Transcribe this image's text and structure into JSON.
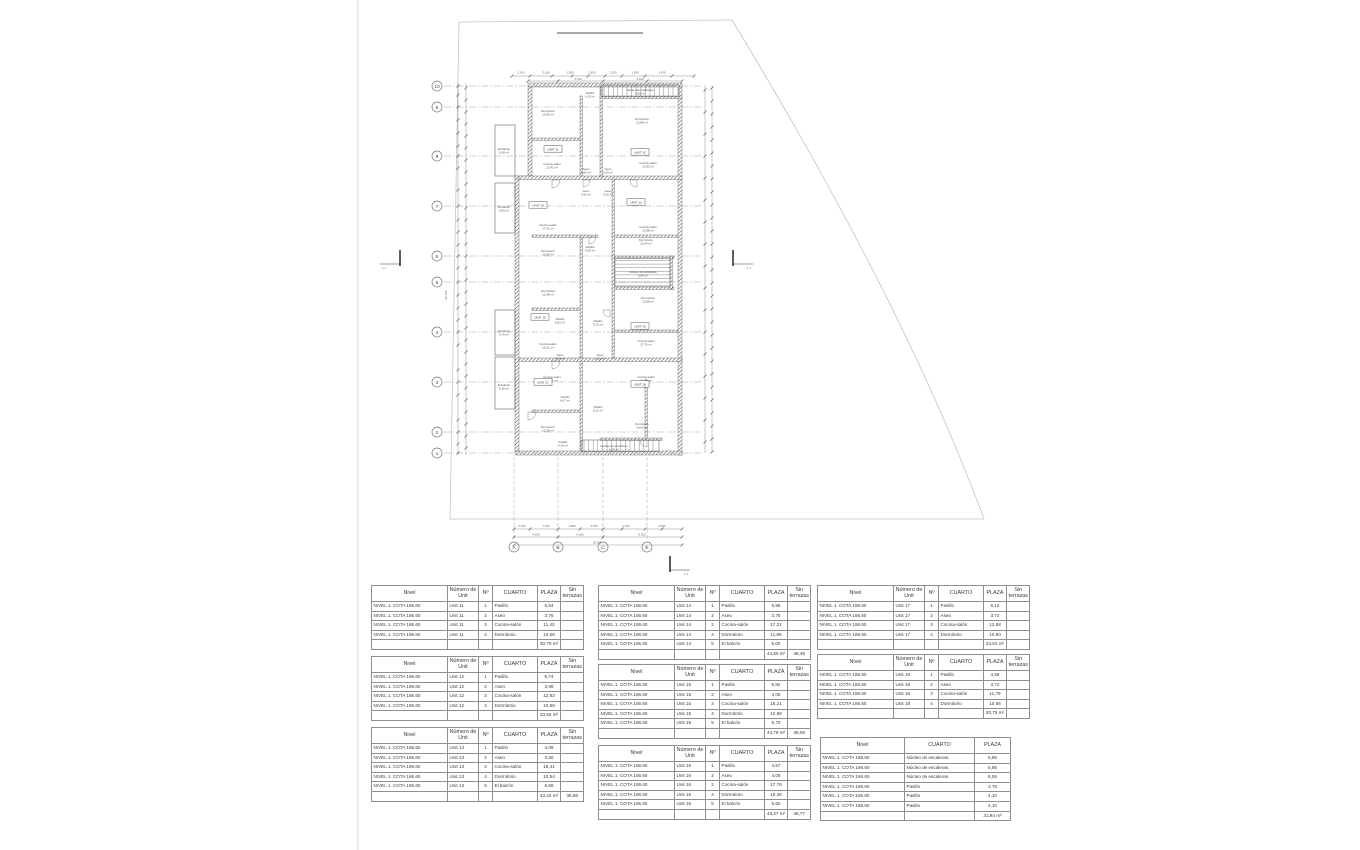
{
  "headers": {
    "unit": [
      "Nivel",
      "Número de Unit",
      "Nº",
      "CUARTO",
      "PLAZA",
      "Sin terrazas"
    ],
    "common": [
      "Nivel",
      "CUARTO",
      "PLAZA"
    ]
  },
  "tables": [
    {
      "name": "schedule-unit-11",
      "type": "unit",
      "x": 371,
      "y": 585,
      "rows": [
        [
          "NIVEL 1. COTA 186.60",
          "Unit 11",
          "1",
          "Pasillo",
          "5,54",
          ""
        ],
        [
          "NIVEL 1. COTA 186.60",
          "Unit 11",
          "2",
          "Aseo",
          "3,76",
          ""
        ],
        [
          "NIVEL 1. COTA 186.60",
          "Unit 11",
          "3",
          "Cocina-salón",
          "11,43",
          ""
        ],
        [
          "NIVEL 1. COTA 186.60",
          "Unit 11",
          "4",
          "Dormitorio",
          "10,06",
          ""
        ]
      ],
      "total_plaza": "30,79 m²",
      "total_sin": ""
    },
    {
      "name": "schedule-unit-12",
      "type": "unit",
      "x": 371,
      "y": 656,
      "rows": [
        [
          "NIVEL 1. COTA 186.60",
          "Unit 12",
          "1",
          "Pasillo",
          "5,74",
          ""
        ],
        [
          "NIVEL 1. COTA 186.60",
          "Unit 12",
          "2",
          "Aseo",
          "3,99",
          ""
        ],
        [
          "NIVEL 1. COTA 186.60",
          "Unit 12",
          "3",
          "Cocina-salón",
          "12,83",
          ""
        ],
        [
          "NIVEL 1. COTA 186.60",
          "Unit 12",
          "4",
          "Dormitorio",
          "10,99",
          ""
        ]
      ],
      "total_plaza": "33,55 m²",
      "total_sin": ""
    },
    {
      "name": "schedule-unit-13",
      "type": "unit",
      "x": 371,
      "y": 727,
      "rows": [
        [
          "NIVEL 1. COTA 186.60",
          "Unit 13",
          "1",
          "Pasillo",
          "4,09",
          ""
        ],
        [
          "NIVEL 1. COTA 186.60",
          "Unit 13",
          "2",
          "Aseo",
          "3,60",
          ""
        ],
        [
          "NIVEL 1. COTA 186.60",
          "Unit 13",
          "3",
          "Cocina-salón",
          "18,41",
          ""
        ],
        [
          "NIVEL 1. COTA 186.60",
          "Unit 13",
          "4",
          "Dormitorio",
          "10,54",
          ""
        ],
        [
          "NIVEL 1. COTA 186.60",
          "Unit 13",
          "5",
          "El balcón",
          "6,68",
          ""
        ]
      ],
      "total_plaza": "43,32 m²",
      "total_sin": "36,68"
    },
    {
      "name": "schedule-unit-14",
      "type": "unit",
      "x": 598,
      "y": 585,
      "rows": [
        [
          "NIVEL 1. COTA 186.60",
          "Unit 14",
          "1",
          "Pasillo",
          "5,95",
          ""
        ],
        [
          "NIVEL 1. COTA 186.60",
          "Unit 14",
          "2",
          "Aseo",
          "3,75",
          ""
        ],
        [
          "NIVEL 1. COTA 186.60",
          "Unit 14",
          "3",
          "Cocina-salón",
          "17,21",
          ""
        ],
        [
          "NIVEL 1. COTA 186.60",
          "Unit 14",
          "4",
          "Dormitorio",
          "11,89",
          ""
        ],
        [
          "NIVEL 1. COTA 186.60",
          "Unit 14",
          "5",
          "El balcón",
          "6,00",
          ""
        ]
      ],
      "total_plaza": "44,80 m²",
      "total_sin": "38,49"
    },
    {
      "name": "schedule-unit-15",
      "type": "unit",
      "x": 598,
      "y": 664,
      "rows": [
        [
          "NIVEL 1. COTA 186.60",
          "Unit 15",
          "1",
          "Pasillo",
          "6,82",
          ""
        ],
        [
          "NIVEL 1. COTA 186.60",
          "Unit 15",
          "2",
          "Aseo",
          "4,08",
          ""
        ],
        [
          "NIVEL 1. COTA 186.60",
          "Unit 15",
          "3",
          "Cocina-salón",
          "15,21",
          ""
        ],
        [
          "NIVEL 1. COTA 186.60",
          "Unit 15",
          "4",
          "Dormitorio",
          "12,98",
          ""
        ],
        [
          "NIVEL 1. COTA 186.60",
          "Unit 15",
          "5",
          "El balcón",
          "5,70",
          ""
        ]
      ],
      "total_plaza": "44,79 m²",
      "total_sin": "39,09"
    },
    {
      "name": "schedule-unit-16",
      "type": "unit",
      "x": 598,
      "y": 745,
      "rows": [
        [
          "NIVEL 1. COTA 186.60",
          "Unit 16",
          "1",
          "Pasillo",
          "4,57",
          ""
        ],
        [
          "NIVEL 1. COTA 186.60",
          "Unit 16",
          "2",
          "Aseo",
          "4,08",
          ""
        ],
        [
          "NIVEL 1. COTA 186.60",
          "Unit 16",
          "3",
          "Cocina-salón",
          "17,76",
          ""
        ],
        [
          "NIVEL 1. COTA 186.60",
          "Unit 16",
          "4",
          "Dormitorio",
          "10,36",
          ""
        ],
        [
          "NIVEL 1. COTA 186.60",
          "Unit 16",
          "5",
          "El balcón",
          "6,60",
          ""
        ]
      ],
      "total_plaza": "43,37 m²",
      "total_sin": "36,77"
    },
    {
      "name": "schedule-unit-17",
      "type": "unit",
      "x": 817,
      "y": 585,
      "rows": [
        [
          "NIVEL 1. COTA 186.60",
          "Unit 17",
          "1",
          "Pasillo",
          "6,12",
          ""
        ],
        [
          "NIVEL 1. COTA 186.60",
          "Unit 17",
          "2",
          "Aseo",
          "3,72",
          ""
        ],
        [
          "NIVEL 1. COTA 186.60",
          "Unit 17",
          "3",
          "Cocina-salón",
          "12,88",
          ""
        ],
        [
          "NIVEL 1. COTA 186.60",
          "Unit 17",
          "4",
          "Dormitorio",
          "10,80",
          ""
        ]
      ],
      "total_plaza": "33,52 m²",
      "total_sin": ""
    },
    {
      "name": "schedule-unit-18",
      "type": "unit",
      "x": 817,
      "y": 654,
      "rows": [
        [
          "NIVEL 1. COTA 186.60",
          "Unit 18",
          "1",
          "Pasillo",
          "4,58",
          ""
        ],
        [
          "NIVEL 1. COTA 186.60",
          "Unit 18",
          "2",
          "Aseo",
          "3,72",
          ""
        ],
        [
          "NIVEL 1. COTA 186.60",
          "Unit 18",
          "3",
          "Cocina-salón",
          "11,79",
          ""
        ],
        [
          "NIVEL 1. COTA 186.60",
          "Unit 18",
          "4",
          "Dormitorio",
          "10,66",
          ""
        ]
      ],
      "total_plaza": "30,75 m²",
      "total_sin": ""
    },
    {
      "name": "schedule-common-areas",
      "type": "common",
      "x": 820,
      "y": 737,
      "rows": [
        [
          "NIVEL 1. COTA 186.60",
          "Núcleo de escaleras.",
          "5,95"
        ],
        [
          "NIVEL 1. COTA 186.60",
          "Núcleo de escaleras.",
          "5,95"
        ],
        [
          "NIVEL 1. COTA 186.60",
          "Núcleo de escaleras.",
          "8,06"
        ],
        [
          "NIVEL 1. COTA 186.60",
          "Pasillo",
          "3,78"
        ],
        [
          "NIVEL 1. COTA 186.60",
          "Pasillo",
          "4,10"
        ],
        [
          "NIVEL 1. COTA 186.60",
          "Pasillo",
          "4,10"
        ]
      ],
      "total_plaza": "31,94 m²"
    }
  ],
  "plan": {
    "grid_rows": [
      {
        "label": "10",
        "y": 86
      },
      {
        "label": "9",
        "y": 107
      },
      {
        "label": "8",
        "y": 156
      },
      {
        "label": "7",
        "y": 206
      },
      {
        "label": "6",
        "y": 256
      },
      {
        "label": "5",
        "y": 282
      },
      {
        "label": "4",
        "y": 332
      },
      {
        "label": "3",
        "y": 382
      },
      {
        "label": "2",
        "y": 432
      },
      {
        "label": "1",
        "y": 453
      }
    ],
    "grid_cols": [
      {
        "label": "A",
        "x": 514
      },
      {
        "label": "B",
        "x": 558
      },
      {
        "label": "C",
        "x": 603
      },
      {
        "label": "E",
        "x": 647
      }
    ],
    "unit_badges": [
      {
        "label": "UNIT 11",
        "x": 553,
        "y": 150
      },
      {
        "label": "UNIT 12",
        "x": 640,
        "y": 153
      },
      {
        "label": "UNIT 14",
        "x": 538,
        "y": 206
      },
      {
        "label": "UNIT 13",
        "x": 636,
        "y": 203
      },
      {
        "label": "UNIT 15",
        "x": 540,
        "y": 318
      },
      {
        "label": "UNIT 16",
        "x": 640,
        "y": 327
      },
      {
        "label": "UNIT 17",
        "x": 543,
        "y": 383
      },
      {
        "label": "UNIT 18",
        "x": 640,
        "y": 385
      }
    ],
    "room_labels": [
      {
        "t": "Dormitorio|13,69 m²",
        "x": 548,
        "y": 112
      },
      {
        "t": "Pasillo|4,13 m²",
        "x": 590,
        "y": 94
      },
      {
        "t": "Núcleo de escaleras|8,06 m²",
        "x": 640,
        "y": 91
      },
      {
        "t": "Dormitorio|13,88 m²",
        "x": 642,
        "y": 120
      },
      {
        "t": "El balcón|5,68 m²",
        "x": 504,
        "y": 150
      },
      {
        "t": "Cocina-salón|13,41 m²",
        "x": 552,
        "y": 165
      },
      {
        "t": "Aseo|3,85 m²",
        "x": 586,
        "y": 170
      },
      {
        "t": "Aseo|3,64 m²",
        "x": 608,
        "y": 170
      },
      {
        "t": "Cocina-salón|12,83 m²",
        "x": 648,
        "y": 164
      },
      {
        "t": "Aseo|3,91 m²",
        "x": 586,
        "y": 192
      },
      {
        "t": "Aseo|4,16 m²",
        "x": 608,
        "y": 192
      },
      {
        "t": "El balcón|5,55 m²",
        "x": 504,
        "y": 208
      },
      {
        "t": "Cocina-salón|17,21 m²",
        "x": 548,
        "y": 226
      },
      {
        "t": "Cocina-salón|12,88 m²",
        "x": 648,
        "y": 228
      },
      {
        "t": "Dormitorio|11,89 m²",
        "x": 548,
        "y": 252
      },
      {
        "t": "Pasillo|5,95 m²",
        "x": 590,
        "y": 248
      },
      {
        "t": "Dormitorio|13,04 m²",
        "x": 646,
        "y": 241
      },
      {
        "t": "Núcleo de escaleras|5,95 m²",
        "x": 643,
        "y": 273
      },
      {
        "t": "Dormitorio|12,98 m²",
        "x": 548,
        "y": 292
      },
      {
        "t": "Dormitorio|13,88 m²",
        "x": 648,
        "y": 299
      },
      {
        "t": "Pasillo|6,82 m²",
        "x": 560,
        "y": 320
      },
      {
        "t": "Pasillo|6,12 m²",
        "x": 598,
        "y": 322
      },
      {
        "t": "El balcón|5,75 m²",
        "x": 504,
        "y": 332
      },
      {
        "t": "Cocina-salón|15,21 m²",
        "x": 548,
        "y": 345
      },
      {
        "t": "Aseo|4,08 m²",
        "x": 560,
        "y": 356
      },
      {
        "t": "Aseo|5,12 m²",
        "x": 600,
        "y": 356
      },
      {
        "t": "Cocina-salón|17,76 m²",
        "x": 646,
        "y": 342
      },
      {
        "t": "El balcón|5,30 m²",
        "x": 504,
        "y": 386
      },
      {
        "t": "Cocina-salón|18,41 m²",
        "x": 552,
        "y": 378
      },
      {
        "t": "Cocina-salón|11,79 m²",
        "x": 646,
        "y": 378
      },
      {
        "t": "Pasillo|4,67 m²",
        "x": 565,
        "y": 398
      },
      {
        "t": "Pasillo|5,12 m²",
        "x": 598,
        "y": 408
      },
      {
        "t": "Dormitorio|12,36 m²",
        "x": 548,
        "y": 428
      },
      {
        "t": "Dormitorio|10,66 m²",
        "x": 642,
        "y": 425
      },
      {
        "t": "Pasillo|4,10 m²",
        "x": 563,
        "y": 443
      },
      {
        "t": "Núcleo de escaleras|5,95 m²",
        "x": 614,
        "y": 447
      }
    ],
    "dim_top": [
      {
        "t": "2.100",
        "x": 521
      },
      {
        "t": "3.100",
        "x": 546
      },
      {
        "t": "1.850",
        "x": 570
      },
      {
        "t": "2.650",
        "x": 592
      },
      {
        "t": "2.100",
        "x": 613
      },
      {
        "t": "1.550",
        "x": 635
      },
      {
        "t": "1.470",
        "x": 662
      }
    ],
    "dim_top2": [
      {
        "t": "1.700",
        "x": 578
      },
      {
        "t": "4.100",
        "x": 640
      }
    ],
    "dim_bottom1": [
      {
        "t": "2.100",
        "x": 522
      },
      {
        "t": "7.100",
        "x": 546
      },
      {
        "t": "1.850",
        "x": 572
      },
      {
        "t": "3.530",
        "x": 594
      },
      {
        "t": "2.100",
        "x": 626
      },
      {
        "t": "2.850",
        "x": 662
      }
    ],
    "dim_bottom2": [
      {
        "t": "4.100",
        "x": 536
      },
      {
        "t": "6.000",
        "x": 580
      },
      {
        "t": "6.500",
        "x": 642
      }
    ],
    "dim_bottom3": [
      {
        "t": "18.500",
        "x": 597
      }
    ],
    "dim_left_overall": "29.390",
    "section_markers": [
      {
        "x": 400,
        "y": 258,
        "dir": -1,
        "label": "1.1"
      },
      {
        "x": 733,
        "y": 258,
        "dir": 1,
        "label": "1.1"
      },
      {
        "x": 670,
        "y": 564,
        "dir": 1,
        "label": "1.1"
      }
    ]
  }
}
